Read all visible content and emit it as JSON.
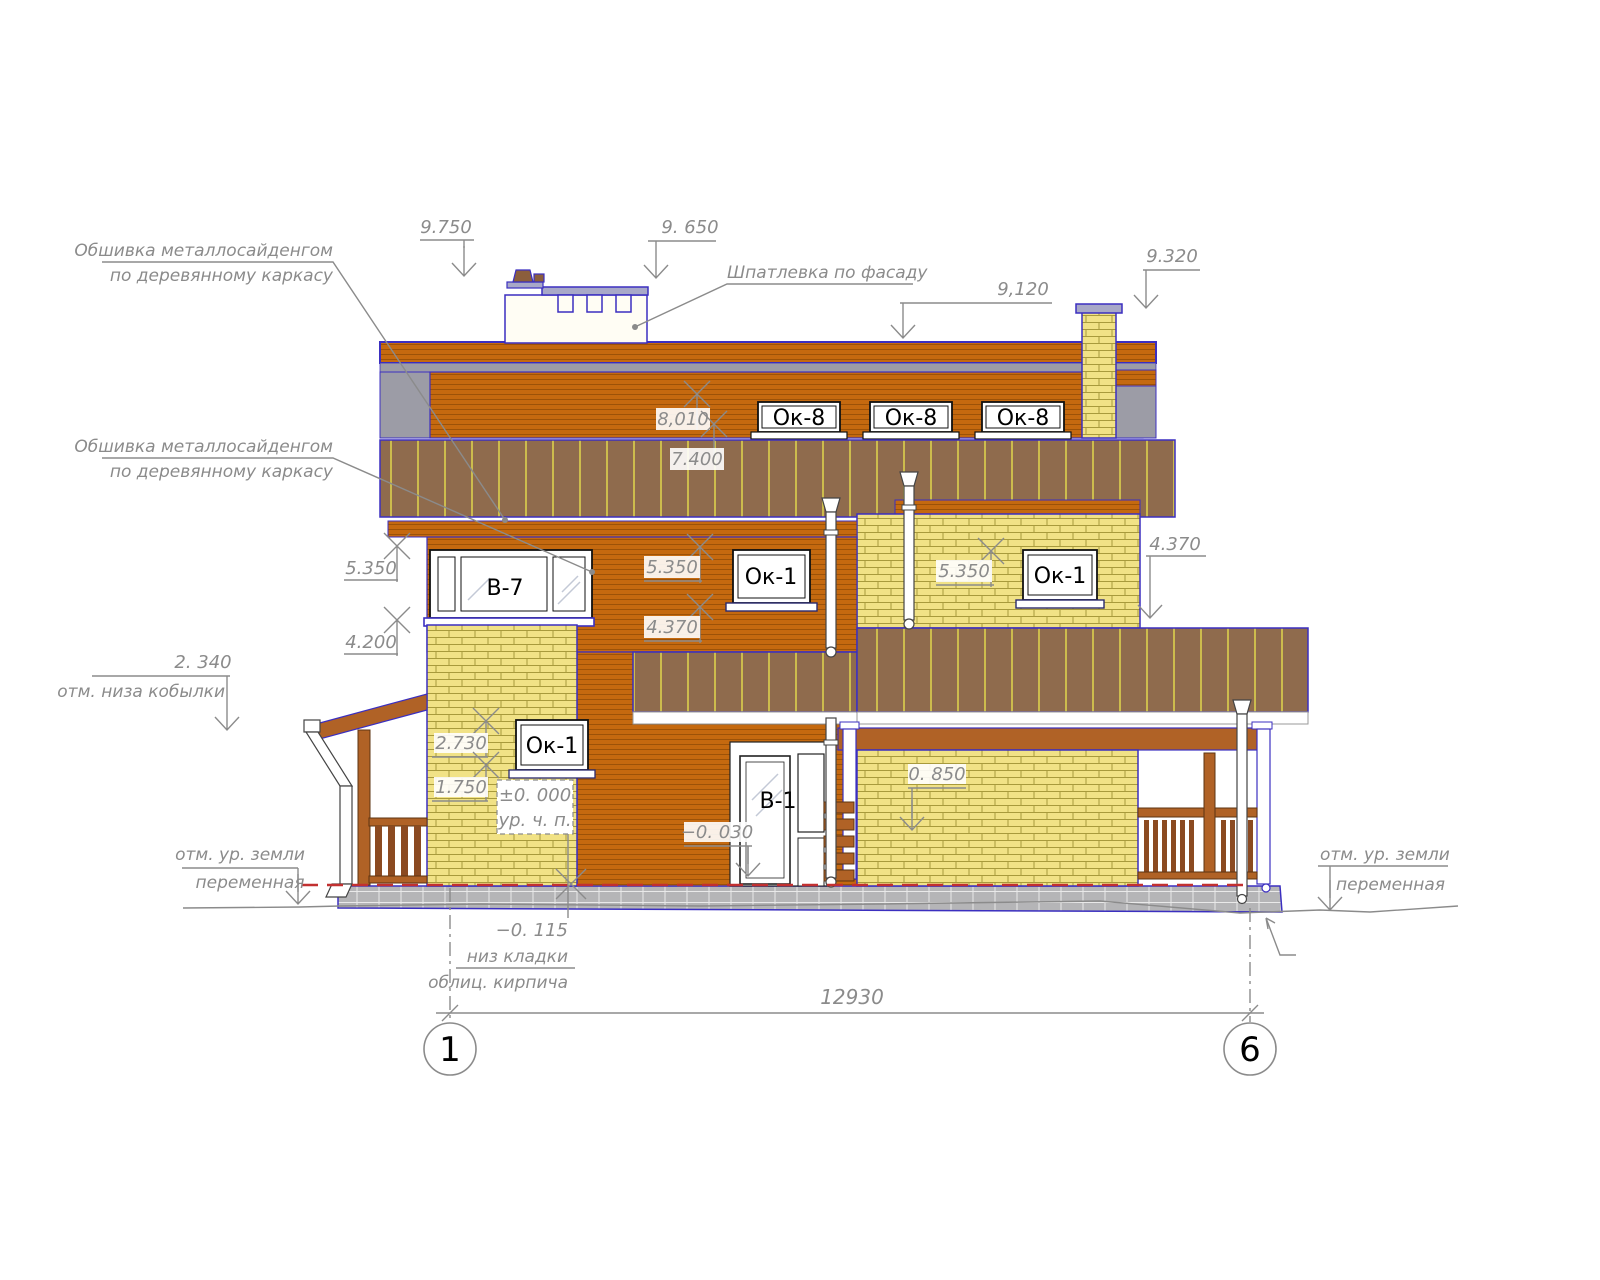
{
  "drawing": {
    "kind": "architectural facade elevation",
    "annotations": {
      "siding1_l1": "Обшивка металлосайденгом",
      "siding1_l2": "по деревянному каркасу",
      "siding2_l1": "Обшивка металлосайденгом",
      "siding2_l2": "по деревянному каркасу",
      "putty": "Шпатлевка по фасаду",
      "kobylka_value": "2. 340",
      "kobylka_label": "отм. низа кобылки",
      "ground_left_l1": "отм. ур. земли",
      "ground_left_l2": "переменная",
      "ground_right_l1": "отм. ур. земли",
      "ground_right_l2": "переменная",
      "zero_value": "±0. 000",
      "zero_label": "ур. ч. п.",
      "minus030": "−0. 030",
      "v0850": "0. 850",
      "minus115": "−0. 115",
      "masonry_l1": "низ кладки",
      "masonry_l2": "облиц. кирпича"
    },
    "levels": {
      "v9750": "9.750",
      "v9650": "9. 650",
      "v9120": "9,120",
      "v9320": "9.320",
      "v8010": "8,010",
      "v7400": "7.400",
      "v5350_left": "5.350",
      "v5350_mid": "5.350",
      "v5350_right": "5.350",
      "v4370_mid": "4.370",
      "v4370_right": "4.370",
      "v4200": "4.200",
      "v2730": "2.730",
      "v1750": "1.750"
    },
    "windows": {
      "ok8_1": "Ок-8",
      "ok8_2": "Ок-8",
      "ok8_3": "Ок-8",
      "b7": "В-7",
      "ok1_mid2f": "Ок-1",
      "ok1_right2f": "Ок-1",
      "ok1_1f": "Ок-1",
      "b1": "В-1"
    },
    "axes": {
      "a1": "1",
      "a6": "6"
    },
    "dimensions": {
      "total": "12930"
    },
    "colors": {
      "siding_orange": "#c5690f",
      "roof_brown": "#8f6b4d",
      "roof_stripe": "#ccbc4d",
      "brick_yellow": "#f1e286",
      "outline_blue": "#3b2fc0",
      "wood_brown": "#b06226",
      "foundation_gray": "#b5b5b7",
      "band_gray": "#9c9ca6",
      "ground_blue": "#27317e",
      "level_red": "#c23030",
      "dim_gray": "#8b8b8b"
    }
  }
}
